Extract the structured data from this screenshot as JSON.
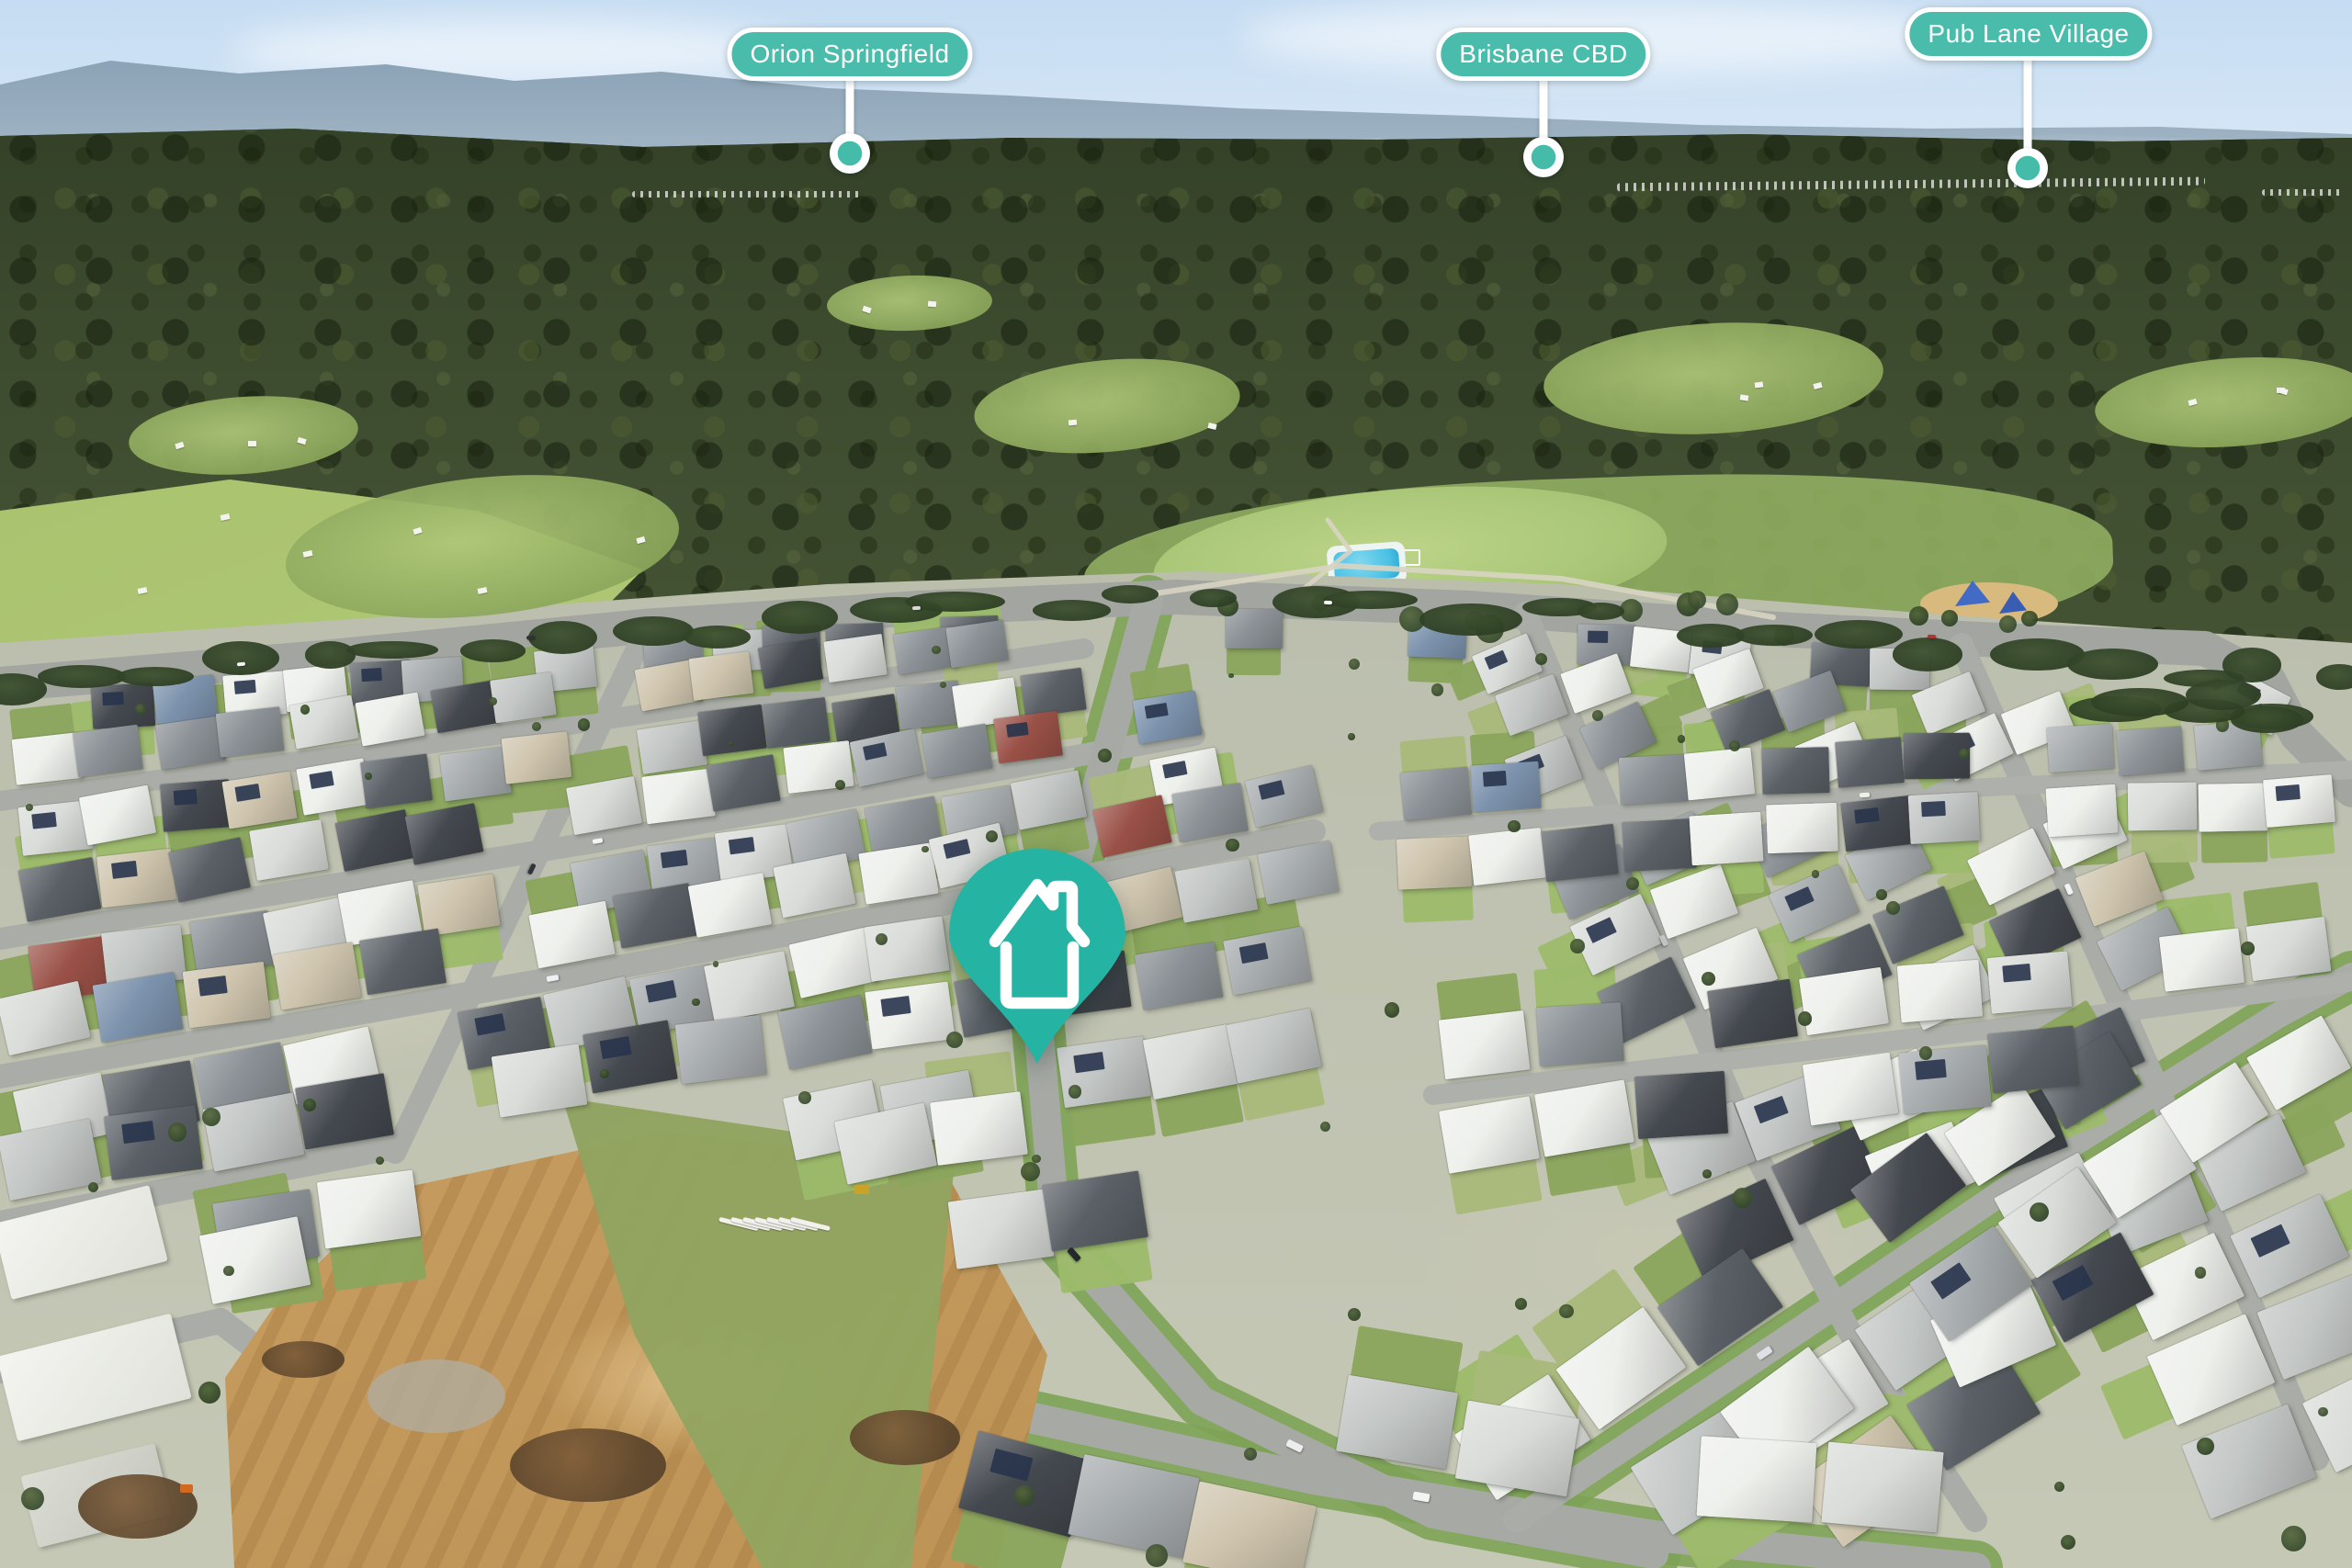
{
  "markers": [
    {
      "label": "Orion Springfield"
    },
    {
      "label": "Brisbane CBD"
    },
    {
      "label": "Pub Lane Village"
    }
  ],
  "pin": {
    "icon": "house-pin-icon"
  },
  "colors": {
    "marker_teal": "#4abcab",
    "pin_teal": "#25b4a3",
    "marker_text": "#ffffff",
    "marker_border": "#ffffff"
  }
}
